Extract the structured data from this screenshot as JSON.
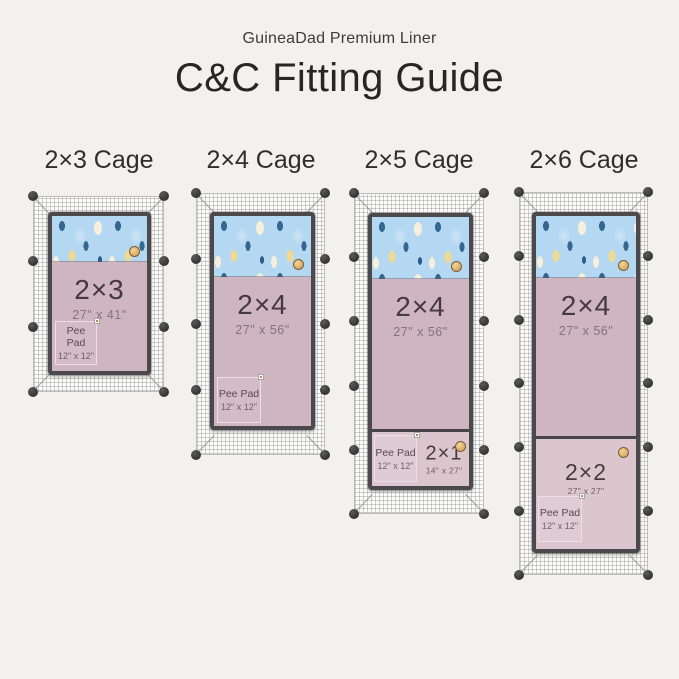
{
  "header": {
    "brand": "GuineaDad Premium Liner",
    "title": "C&C Fitting Guide"
  },
  "cages": [
    {
      "heading": "2×3 Cage",
      "liner": {
        "label": "2×3",
        "dims": "27\" x 41\""
      },
      "pee_pad": {
        "label": "Pee Pad",
        "dims": "12\" x 12\""
      }
    },
    {
      "heading": "2×4 Cage",
      "liner": {
        "label": "2×4",
        "dims": "27\" x 56\""
      },
      "pee_pad": {
        "label": "Pee Pad",
        "dims": "12\" x 12\""
      }
    },
    {
      "heading": "2×5 Cage",
      "liner": {
        "label": "2×4",
        "dims": "27\" x 56\""
      },
      "extra": {
        "label": "2×1",
        "dims": "14\" x 27\""
      },
      "pee_pad": {
        "label": "Pee Pad",
        "dims": "12\" x 12\""
      }
    },
    {
      "heading": "2×6 Cage",
      "liner": {
        "label": "2×4",
        "dims": "27\" x 56\""
      },
      "extra": {
        "label": "2×2",
        "dims": "27\" x 27\""
      },
      "pee_pad": {
        "label": "Pee Pad",
        "dims": "12\" x 12\""
      }
    }
  ],
  "colors": {
    "background": "#f2f1f0",
    "fleece_blue": "#b4d7f2",
    "liner_pink": "#cfb5bf",
    "liner_pink_light": "#dcc6ce",
    "frame_dark": "#4c494c",
    "connector_ball": "#3d3d3d",
    "badge_gold": "#d9a95f"
  }
}
